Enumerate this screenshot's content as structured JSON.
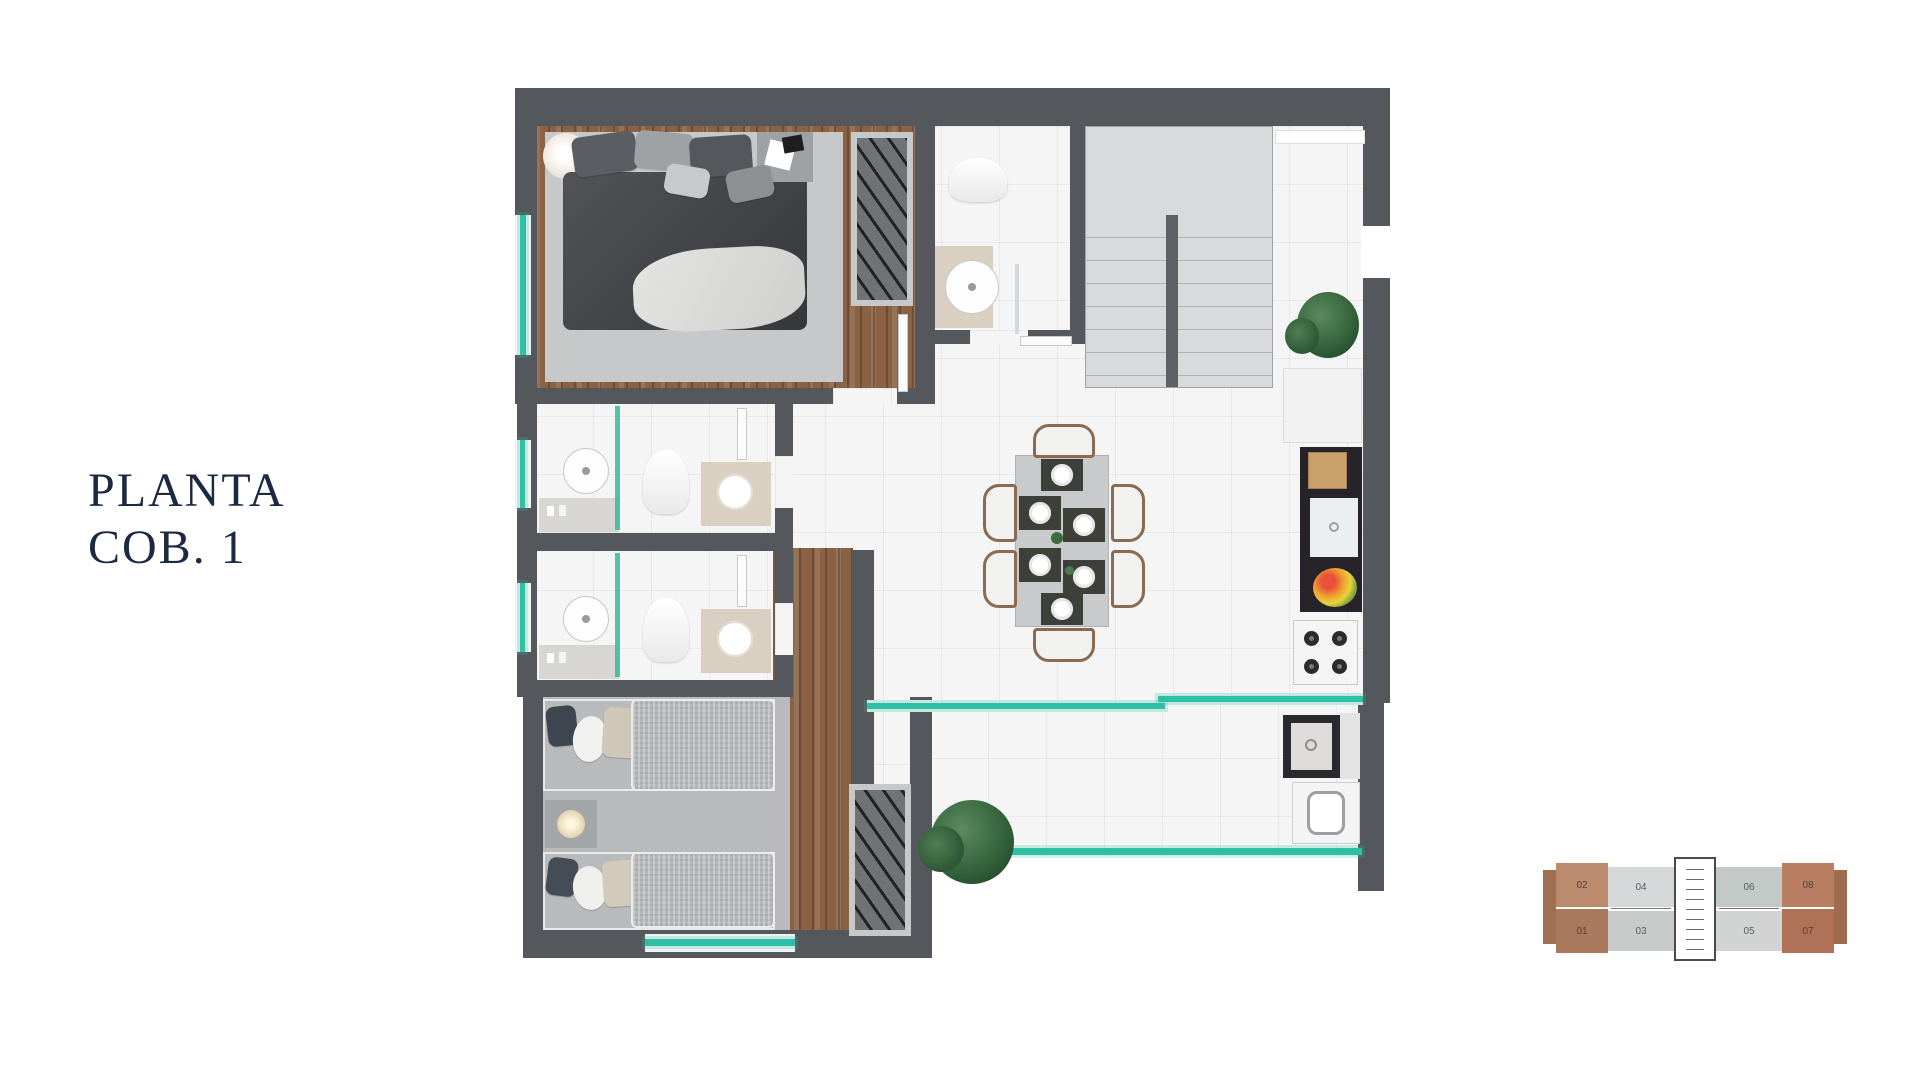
{
  "title": {
    "line1": "PLANTA",
    "line2": "COB. 1"
  },
  "key_plan": {
    "units": [
      {
        "label": "02",
        "color": "#bc8a6d",
        "highlighted": true
      },
      {
        "label": "04",
        "color": "#d5d7d8",
        "highlighted": false
      },
      {
        "label": "06",
        "color": "#c3c9c6",
        "highlighted": false
      },
      {
        "label": "08",
        "color": "#ba7f63",
        "highlighted": true
      },
      {
        "label": "01",
        "color": "#aa795d",
        "highlighted": true
      },
      {
        "label": "03",
        "color": "#c7cbc9",
        "highlighted": false
      },
      {
        "label": "05",
        "color": "#d2d4d4",
        "highlighted": false
      },
      {
        "label": "07",
        "color": "#b07257",
        "highlighted": true
      }
    ]
  },
  "palette": {
    "wall": "#54585c",
    "glass": "#2fbfa4",
    "wood": "#8a6243",
    "marble": "#f5f5f6",
    "title_color": "#1c2942",
    "tab_left": "#a06e53",
    "tab_right": "#9f6c50"
  }
}
